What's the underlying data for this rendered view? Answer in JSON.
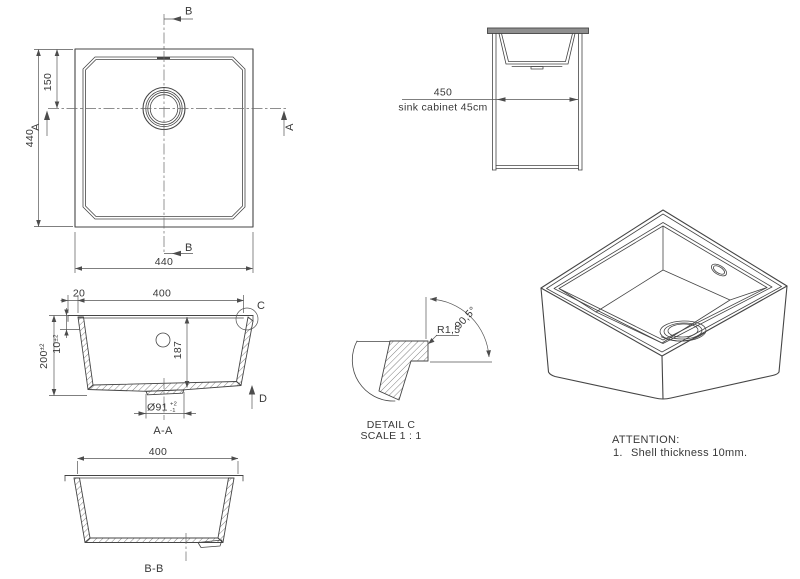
{
  "front": {
    "b_top": "B",
    "b_bottom": "B",
    "a_left": "A",
    "a_right": "A",
    "dim_side": "440",
    "dim_offset": "150",
    "dim_bottom": "440"
  },
  "cabinet": {
    "dim": "450",
    "caption": "sink cabinet 45cm"
  },
  "aa": {
    "dim_lip": "20",
    "dim_width": "400",
    "dim_height": "200",
    "dim_height_tol": "±2",
    "dim_wall": "10",
    "dim_wall_tol": "±2",
    "dim_depth": "187",
    "drain_dia": "Ø91",
    "drain_tol_plus": "+2",
    "drain_tol_minus": "-1",
    "c_label": "C",
    "d_label": "D",
    "title": "A-A"
  },
  "detail": {
    "radius": "R1,5",
    "angle": "90,5°",
    "title": "DETAIL C",
    "scale": "SCALE 1 : 1"
  },
  "bb": {
    "dim_width": "400",
    "title": "B-B"
  },
  "attention": {
    "heading": "ATTENTION:",
    "item_no": "1.",
    "item_text": "Shell thickness 10mm."
  },
  "colors": {
    "line": "#454545",
    "dimension": "#555555",
    "text": "#383838",
    "counter_fill": "#8f8f8f"
  }
}
